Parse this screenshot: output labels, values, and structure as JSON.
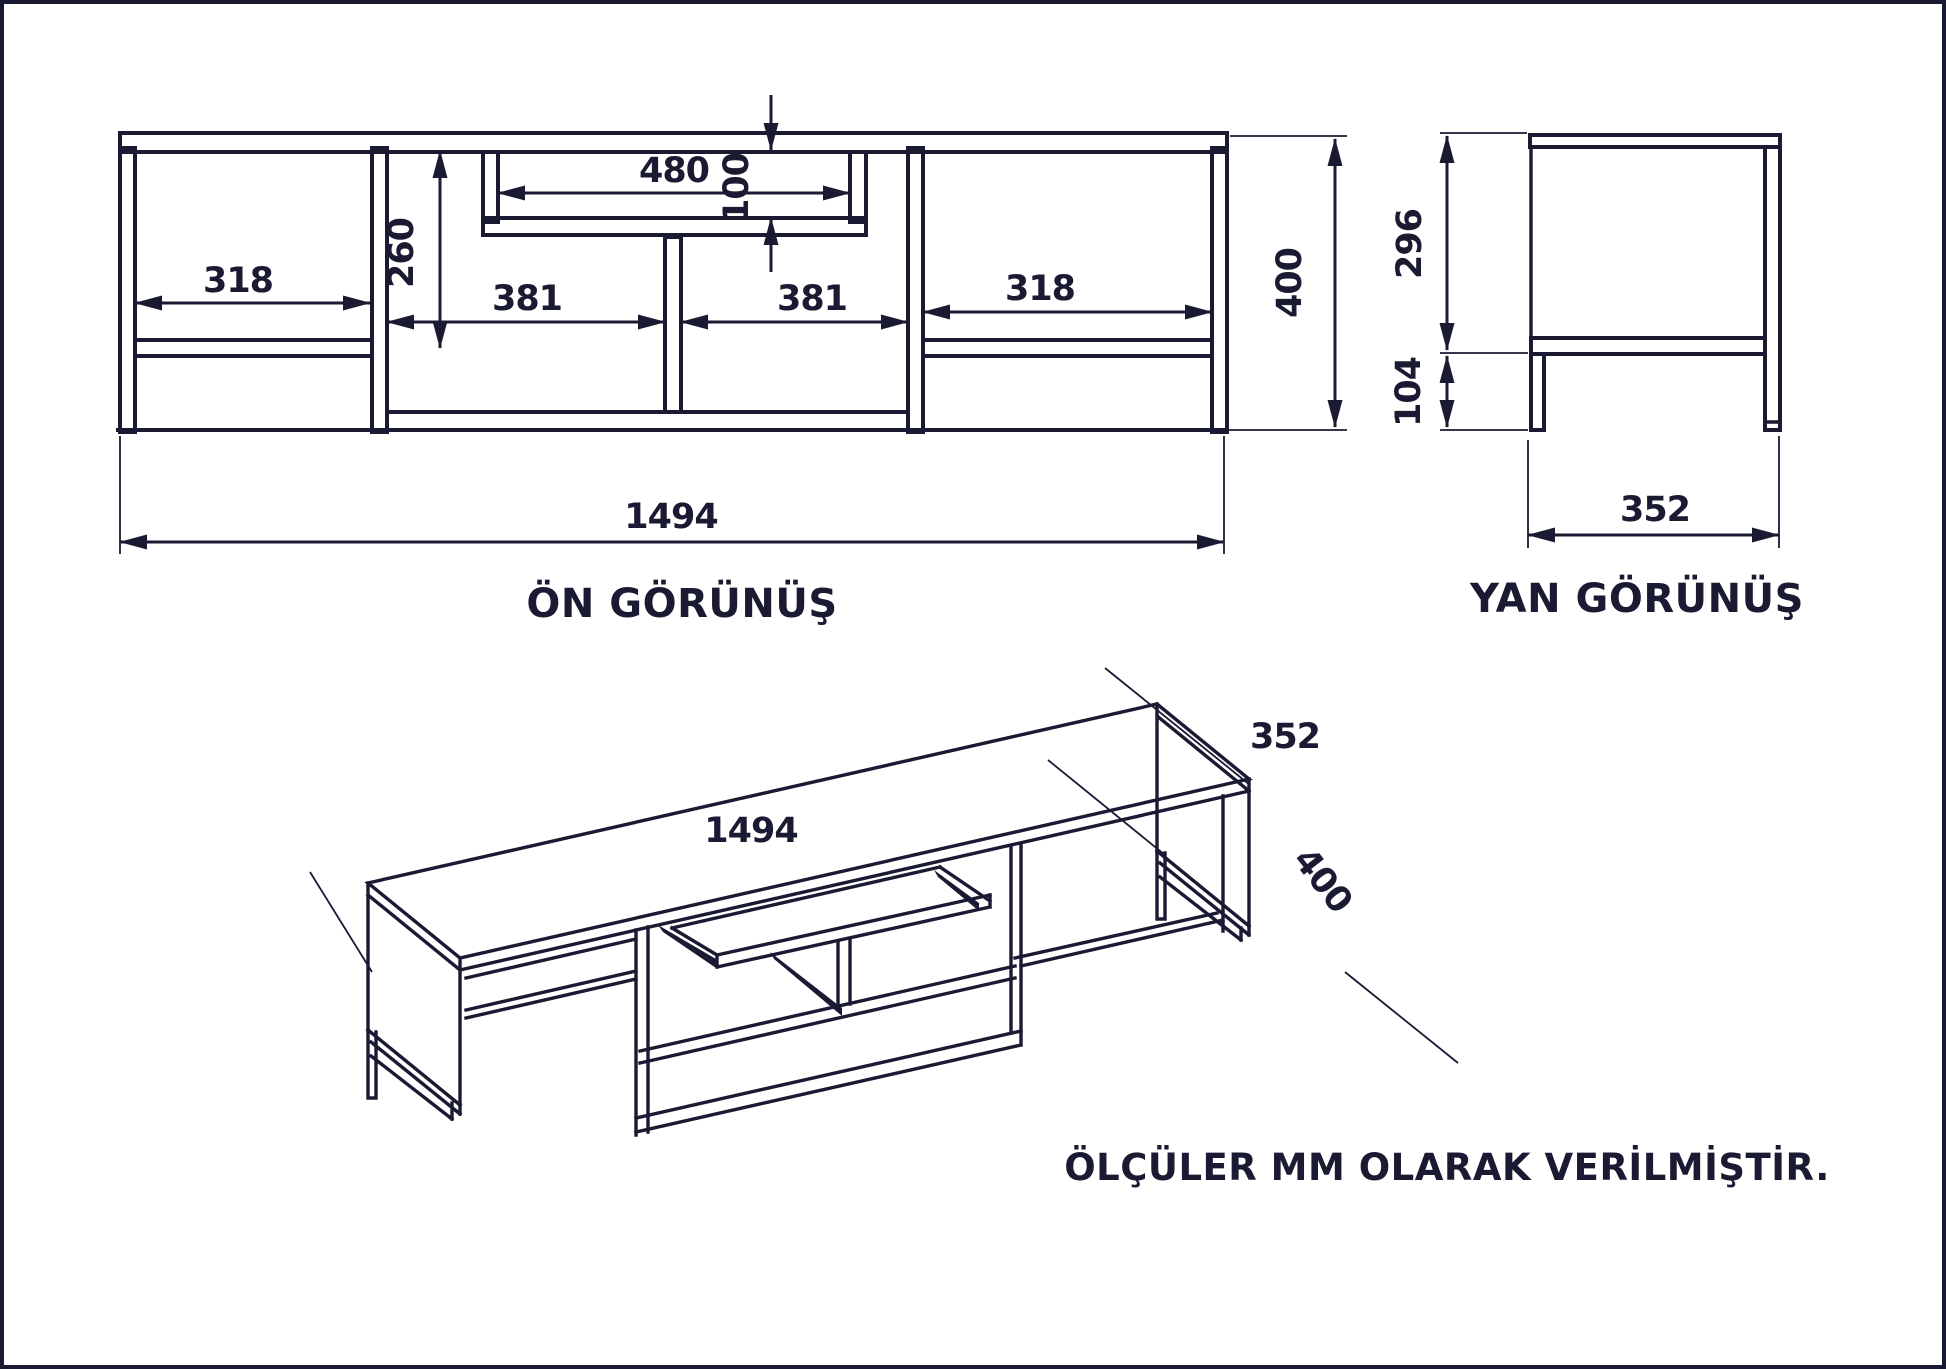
{
  "drawing": {
    "units_note": "ÖLÇÜLER MM OLARAK VERİLMİŞTİR.",
    "colors": {
      "line": "#1a1a33",
      "background": "#ffffff"
    },
    "front_view": {
      "label": "ÖN GÖRÜNÜŞ",
      "dim_left_compartment": "318",
      "dim_mid_left_compartment": "381",
      "dim_mid_right_compartment": "381",
      "dim_right_compartment": "318",
      "dim_upper_height": "260",
      "dim_niche_width": "480",
      "dim_niche_height": "100",
      "dim_total_height": "400",
      "dim_total_width": "1494"
    },
    "side_view": {
      "label": "YAN GÖRÜNÜŞ",
      "dim_body_height": "296",
      "dim_leg_height": "104",
      "dim_depth": "352"
    },
    "iso_view": {
      "dim_length": "1494",
      "dim_depth": "352",
      "dim_height": "400"
    }
  }
}
